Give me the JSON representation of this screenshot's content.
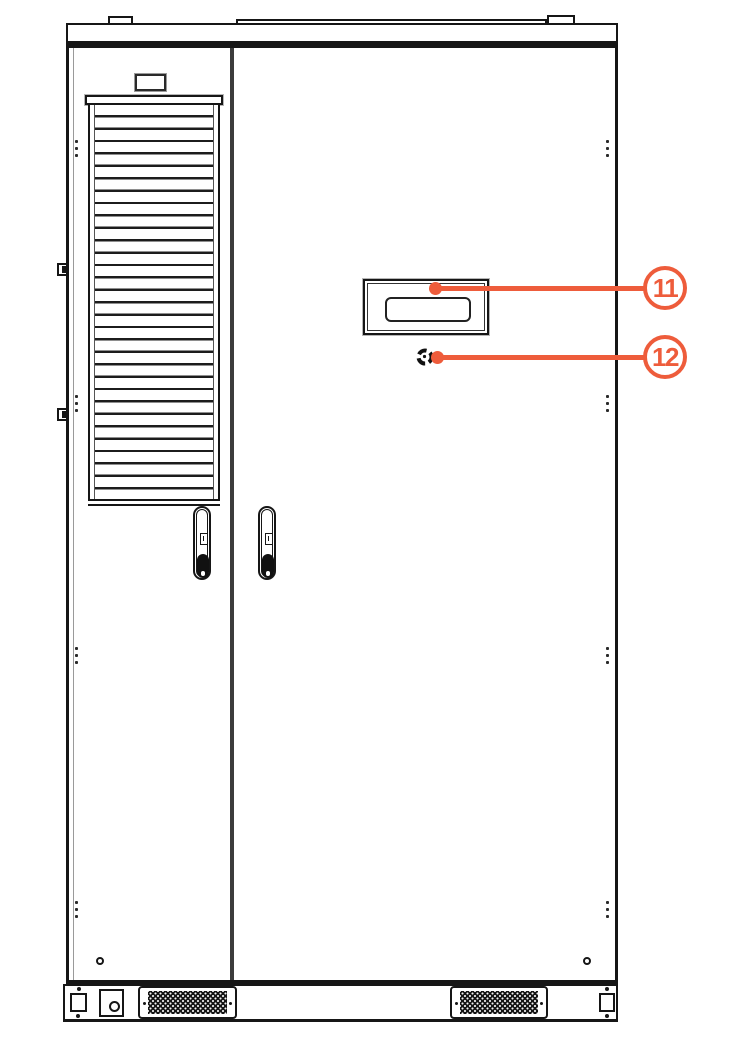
{
  "colors": {
    "accent": "#EE5C3B",
    "line": "#161616",
    "divider": "#3C3C3C"
  },
  "callouts": [
    {
      "number": "11",
      "points_to": "display-window"
    },
    {
      "number": "12",
      "points_to": "round-release-button"
    }
  ],
  "icons": [
    "louver-vent-icon",
    "door-handle-icon",
    "keyhole-icon",
    "display-window-icon",
    "round-release-button-icon",
    "vent-grille-icon",
    "hinge-icon",
    "rivet-dots-icon",
    "foot-bracket-icon"
  ]
}
